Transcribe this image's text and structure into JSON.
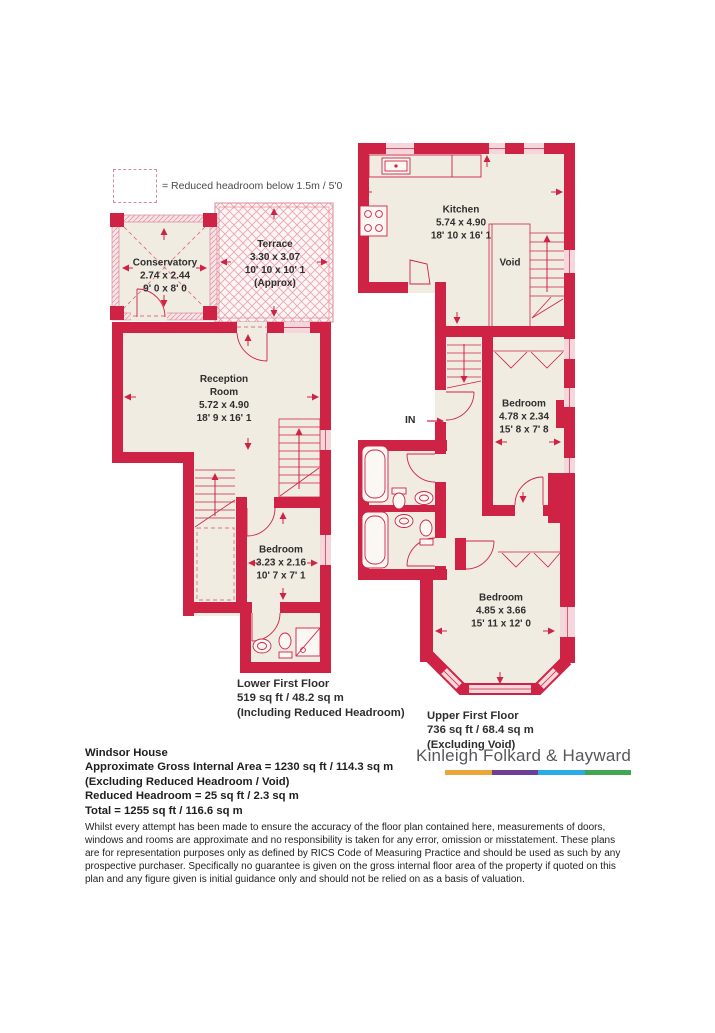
{
  "legend": {
    "label": "= Reduced headroom below 1.5m / 5'0"
  },
  "plans": {
    "lower": {
      "rooms": {
        "conservatory": {
          "name": "Conservatory",
          "metric": "2.74 x 2.44",
          "imperial": "9' 0 x 8' 0"
        },
        "terrace": {
          "name": "Terrace",
          "metric": "3.30 x 3.07",
          "imperial": "10' 10 x 10' 1",
          "note": "(Approx)"
        },
        "reception": {
          "name": "Reception Room",
          "metric": "5.72 x 4.90",
          "imperial": "18' 9 x 16' 1"
        },
        "bedroom": {
          "name": "Bedroom",
          "metric": "3.23 x 2.16",
          "imperial": "10' 7 x 7' 1"
        }
      },
      "label": {
        "title": "Lower First Floor",
        "area": "519 sq ft / 48.2 sq m",
        "note": "(Including Reduced Headroom)"
      }
    },
    "upper": {
      "rooms": {
        "kitchen": {
          "name": "Kitchen",
          "metric": "5.74 x 4.90",
          "imperial": "18' 10 x 16' 1"
        },
        "void": {
          "name": "Void"
        },
        "bedroom_mid": {
          "name": "Bedroom",
          "metric": "4.78 x 2.34",
          "imperial": "15' 8 x 7' 8"
        },
        "bedroom_front": {
          "name": "Bedroom",
          "metric": "4.85 x 3.66",
          "imperial": "15' 11 x 12' 0"
        }
      },
      "entrance": "IN",
      "label": {
        "title": "Upper First Floor",
        "area": "736 sq ft / 68.4 sq m",
        "note": "(Excluding Void)"
      }
    }
  },
  "summary": {
    "property": "Windsor House",
    "gross": "Approximate Gross Internal Area = 1230 sq ft / 114.3 sq m",
    "excluding": "(Excluding Reduced Headroom / Void)",
    "reduced": "Reduced Headroom = 25 sq ft / 2.3 sq m",
    "total": "Total = 1255 sq ft / 116.6 sq m"
  },
  "disclaimer": "Whilst every attempt has been made to ensure the accuracy of the floor plan contained here, measurements of doors, windows and rooms are approximate and no responsibility is taken for any error, omission or misstatement. These plans are for representation purposes only as defined by RICS Code of Measuring Practice and should be used as such by any prospective purchaser. Specifically no guarantee is given on the gross internal floor area of the property if quoted on this plan and any figure given is initial guidance only and should not be relied on as a basis of valuation.",
  "brand": {
    "name": "Kinleigh Folkard & Hayward",
    "stripe": [
      "#eaa63b",
      "#6e3f97",
      "#2aabe2",
      "#41a551"
    ]
  },
  "colors": {
    "wall": "#cf2345",
    "floor": "#f0ece2",
    "window": "#f5d7db",
    "text": "#2e2e2e"
  }
}
